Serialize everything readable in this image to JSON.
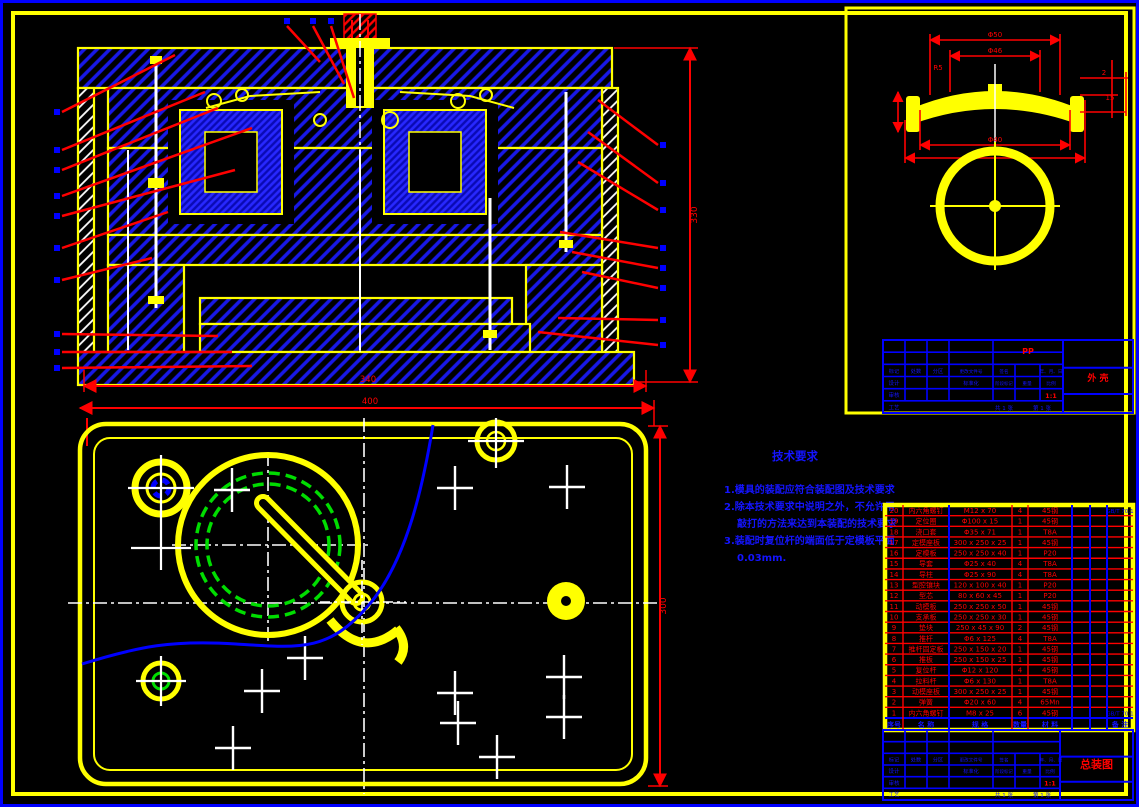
{
  "drawing_type": "injection-mold-assembly-cad-drawing",
  "technical_requirements": {
    "title": "技术要求",
    "lines": [
      "1.模具的装配应符合装配图及技术要求",
      "2.除本技术要求中说明之外，不允许用",
      "敲打的方法来达到本装配的技术要求",
      "3.装配时复位杆的端面低于定模板平面",
      "0.03mm."
    ]
  },
  "dimensions": {
    "front_width": "340",
    "base_width": "400",
    "front_height": "330",
    "plan_depth": "300",
    "detail_dims": [
      "Φ50",
      "Φ46",
      "R5",
      "2",
      "15",
      "Φ40"
    ]
  },
  "detail_block": {
    "material": "PP",
    "part_name": "外 壳",
    "scale": "1:1"
  },
  "main_block": {
    "drawing_name": "总装图",
    "scale": "1:1"
  },
  "title_block_labels": {
    "row1": [
      "标记",
      "处数",
      "分区",
      "更改文件号",
      "签名",
      "年、月、日"
    ],
    "design": "设计",
    "check": "审核",
    "process": "工艺",
    "standardize": "标准化",
    "stage_mark": "阶段标记",
    "weight": "重量",
    "scale_label": "比例",
    "sheet_total": "共 1 张",
    "sheet_no": "第 1 张"
  },
  "parts_table": {
    "headers": [
      "序号",
      "名  称",
      "规  格",
      "数量",
      "材  料",
      "备  注"
    ],
    "rows": [
      [
        "20",
        "内六角螺钉",
        "M12 x 70",
        "4",
        "45钢",
        "GB/T 70.1"
      ],
      [
        "19",
        "定位圈",
        "Φ100 x 15",
        "1",
        "45钢",
        ""
      ],
      [
        "18",
        "浇口套",
        "Φ35 x 71",
        "1",
        "T8A",
        ""
      ],
      [
        "17",
        "定模座板",
        "300 x 250 x 25",
        "1",
        "45钢",
        ""
      ],
      [
        "16",
        "定模板",
        "250 x 250 x 40",
        "1",
        "P20",
        ""
      ],
      [
        "15",
        "导套",
        "Φ25 x 40",
        "4",
        "T8A",
        ""
      ],
      [
        "14",
        "导柱",
        "Φ25 x 90",
        "4",
        "T8A",
        ""
      ],
      [
        "13",
        "型腔镶块",
        "120 x 100 x 40",
        "1",
        "P20",
        ""
      ],
      [
        "12",
        "型芯",
        "80 x 60 x 45",
        "1",
        "P20",
        ""
      ],
      [
        "11",
        "动模板",
        "250 x 250 x 50",
        "1",
        "45钢",
        ""
      ],
      [
        "10",
        "支承板",
        "250 x 250 x 30",
        "1",
        "45钢",
        ""
      ],
      [
        "9",
        "垫块",
        "250 x 45 x 90",
        "2",
        "45钢",
        ""
      ],
      [
        "8",
        "推杆",
        "Φ6 x 125",
        "4",
        "T8A",
        ""
      ],
      [
        "7",
        "推杆固定板",
        "250 x 150 x 20",
        "1",
        "45钢",
        ""
      ],
      [
        "6",
        "推板",
        "250 x 150 x 25",
        "1",
        "45钢",
        ""
      ],
      [
        "5",
        "复位杆",
        "Φ12 x 120",
        "4",
        "45钢",
        ""
      ],
      [
        "4",
        "拉料杆",
        "Φ6 x 130",
        "1",
        "T8A",
        ""
      ],
      [
        "3",
        "动模座板",
        "300 x 250 x 25",
        "1",
        "45钢",
        ""
      ],
      [
        "2",
        "弹簧",
        "Φ20 x 60",
        "4",
        "65Mn",
        ""
      ],
      [
        "1",
        "内六角螺钉",
        "M8 x 25",
        "6",
        "45钢",
        "GB/T 70.1"
      ]
    ]
  },
  "colors": {
    "line_yellow": "#FFFF00",
    "hatch_blue": "#1818E8",
    "annotation_red": "#FF0000",
    "text_blue": "#1414FF",
    "detail_green": "#00DD00",
    "pin_white": "#FFFFFF"
  }
}
